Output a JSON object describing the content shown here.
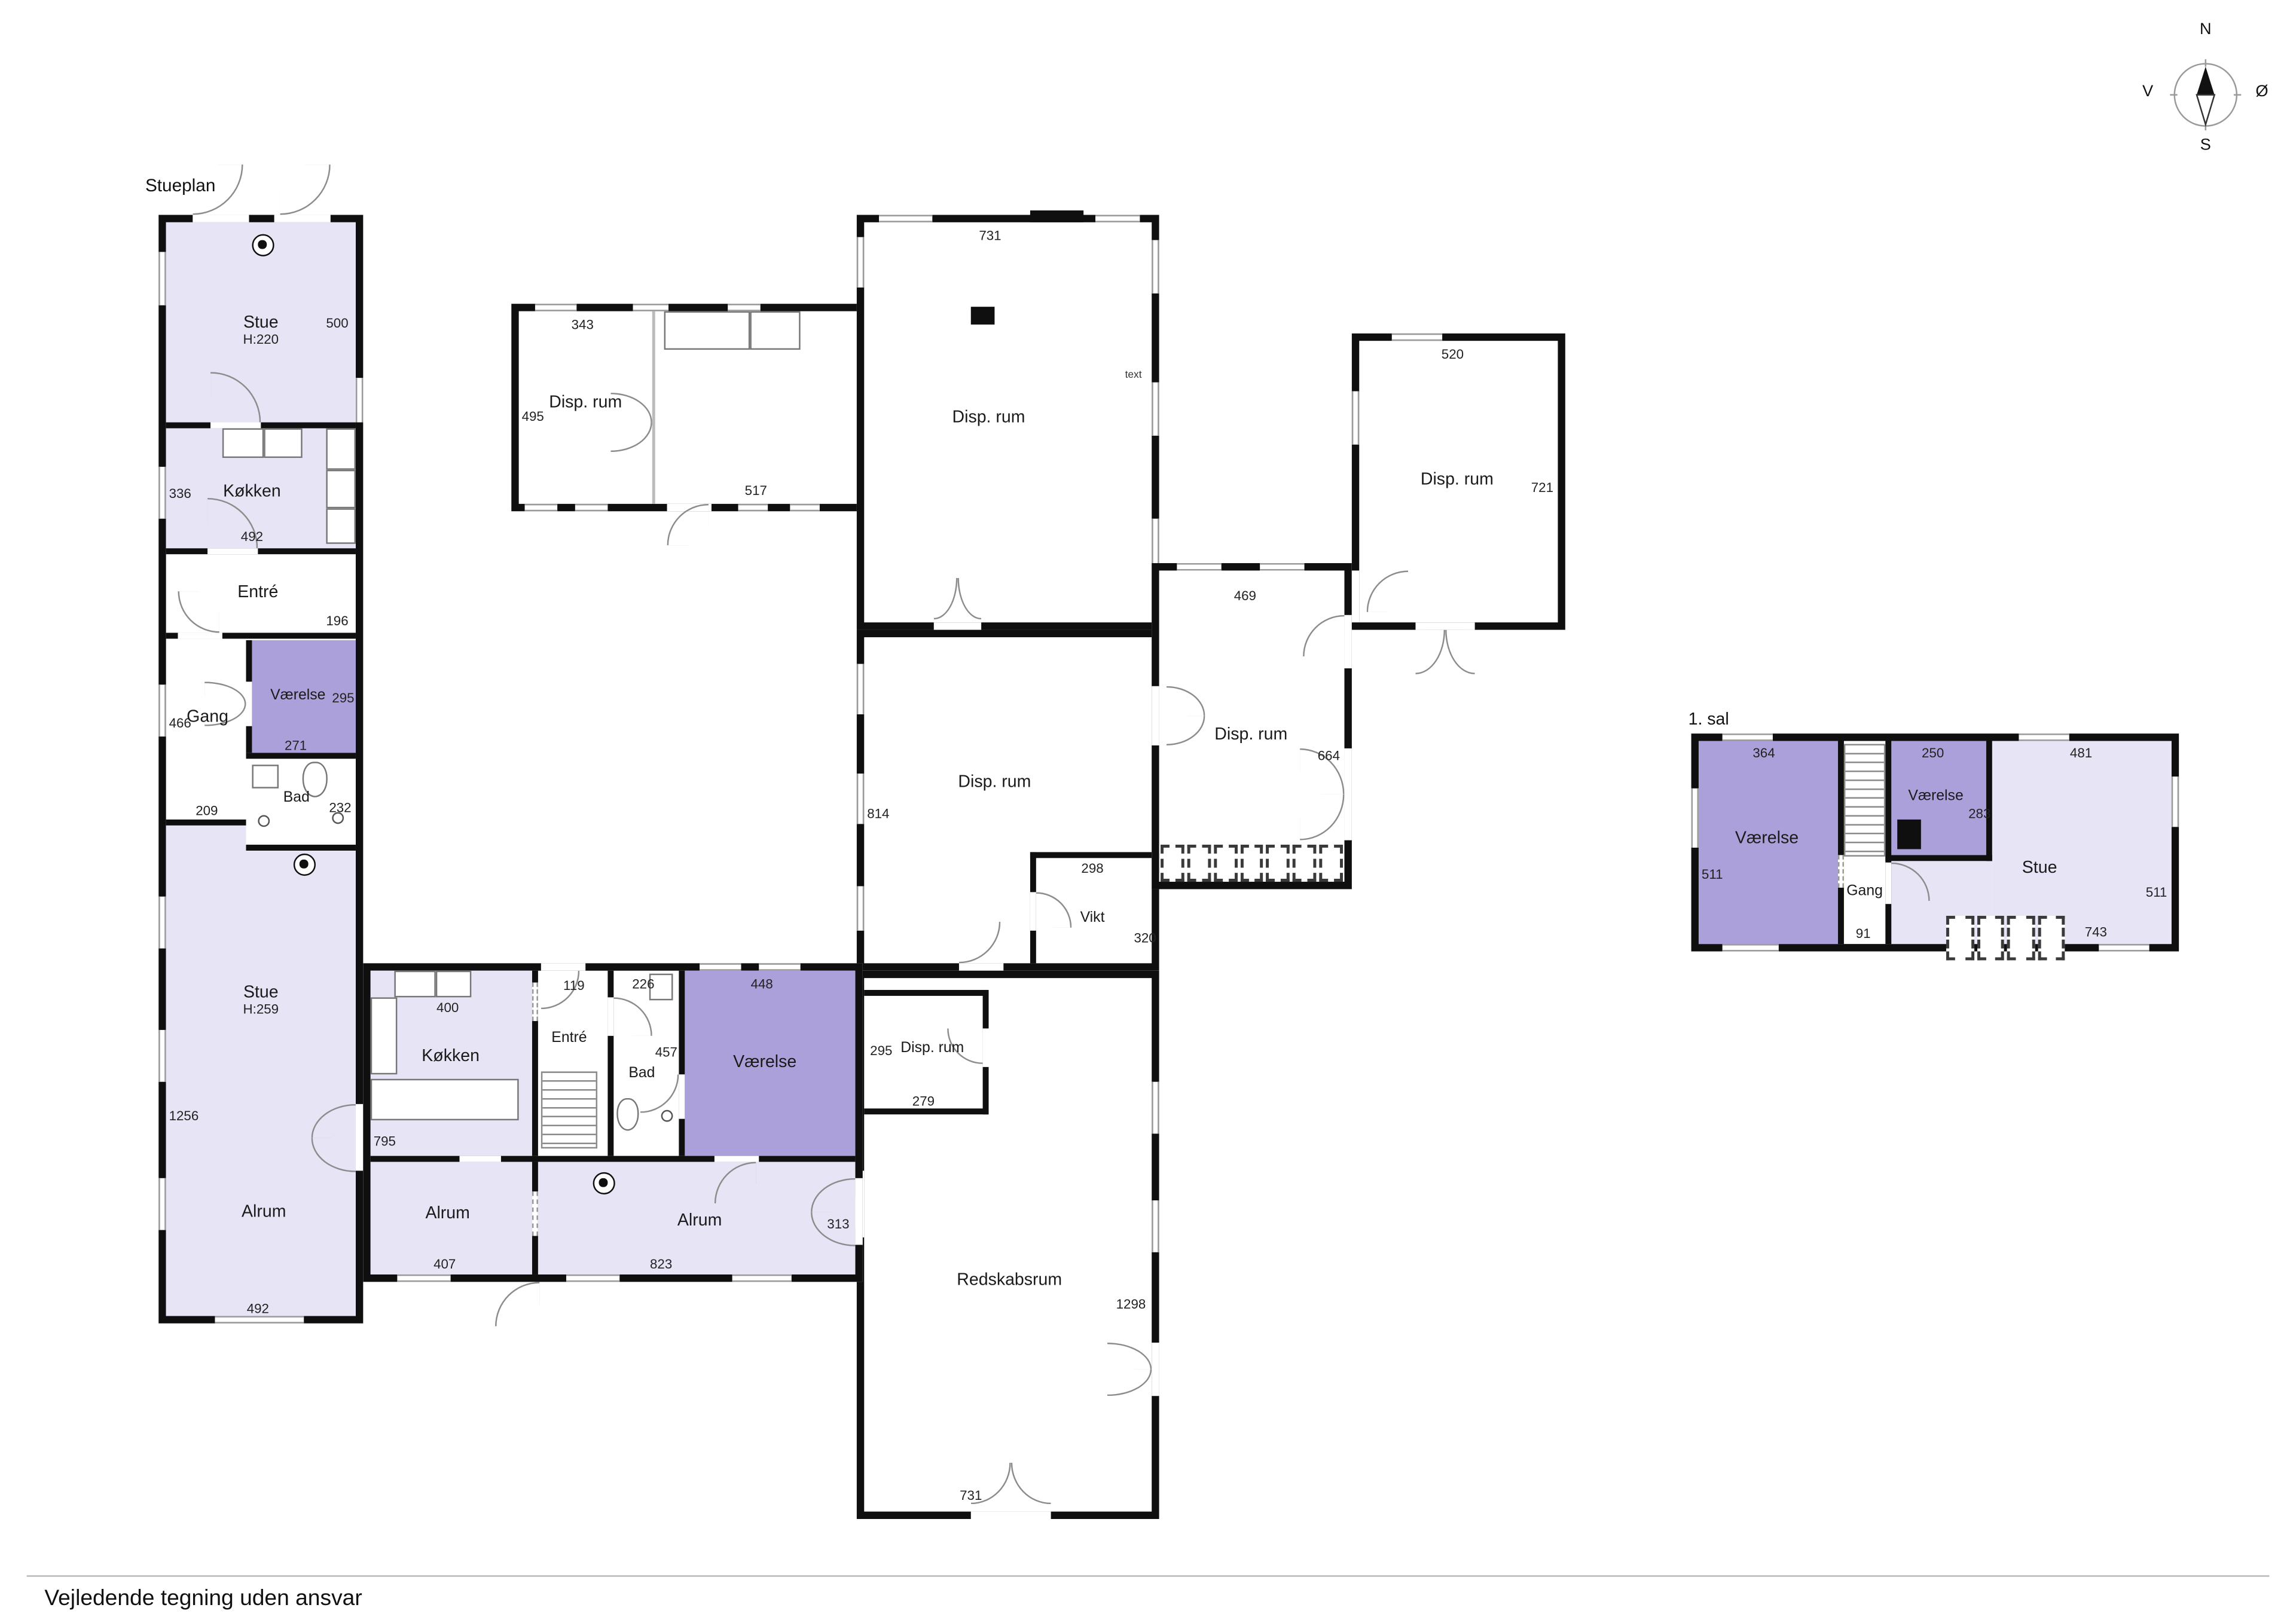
{
  "title_ground": "Stueplan",
  "title_first": "1. sal",
  "disclaimer": "Vejledende tegning uden ansvar",
  "compass": {
    "n": "N",
    "e": "Ø",
    "s": "S",
    "w": "V"
  },
  "colors": {
    "room_light": "#e7e4f5",
    "room_medium": "#aba0d9",
    "wall": "#0f0f0f"
  },
  "rooms": {
    "stue_nw": {
      "label": "Stue",
      "ceil": "H:220",
      "right": "500"
    },
    "kokken_w": {
      "label": "Køkken",
      "left": "336",
      "bottom": "492"
    },
    "entre_w": {
      "label": "Entré",
      "right": "196"
    },
    "gang_w": {
      "label": "Gang",
      "left": "466",
      "bottom": "209"
    },
    "vaerelse_w": {
      "label": "Værelse",
      "right": "295",
      "bottom": "271"
    },
    "bad_w": {
      "label": "Bad",
      "right": "232"
    },
    "stue_sw": {
      "label": "Stue",
      "ceil": "H:259",
      "left": "1256"
    },
    "alrum_sw": {
      "label": "Alrum",
      "bottom": "492"
    },
    "disp_nw": {
      "label": "Disp. rum",
      "top": "343",
      "left": "495",
      "bottom": "517"
    },
    "disp_n": {
      "label": "Disp. rum",
      "top": "731",
      "note": "text"
    },
    "disp_mid": {
      "label": "Disp. rum",
      "left": "814"
    },
    "vikt": {
      "label": "Vikt",
      "top": "298",
      "right": "320"
    },
    "disp_e": {
      "label": "Disp. rum",
      "top": "469",
      "right": "664"
    },
    "disp_ne": {
      "label": "Disp. rum",
      "top": "520",
      "right": "721"
    },
    "kokken_s": {
      "label": "Køkken",
      "top": "400",
      "bottom": "795"
    },
    "entre_s": {
      "label": "Entré",
      "top": "119"
    },
    "bad_s": {
      "label": "Bad",
      "top": "226",
      "right": "457"
    },
    "vaerelse_s": {
      "label": "Værelse",
      "top": "448"
    },
    "disp_s": {
      "label": "Disp. rum",
      "left": "295",
      "bottom": "279"
    },
    "alrum_s1": {
      "label": "Alrum",
      "bottom": "407"
    },
    "alrum_s2": {
      "label": "Alrum",
      "bottom": "823",
      "right": "313"
    },
    "redskabsrum": {
      "label": "Redskabsrum",
      "right": "1298",
      "bottom": "731"
    },
    "fs_vaerelse_w": {
      "label": "Værelse",
      "top": "364",
      "left": "511"
    },
    "fs_gang": {
      "label": "Gang",
      "bottom": "91"
    },
    "fs_vaerelse_e": {
      "label": "Værelse",
      "top": "250",
      "right": "283"
    },
    "fs_stue": {
      "label": "Stue",
      "top": "481",
      "right": "511",
      "bottom": "743"
    }
  }
}
